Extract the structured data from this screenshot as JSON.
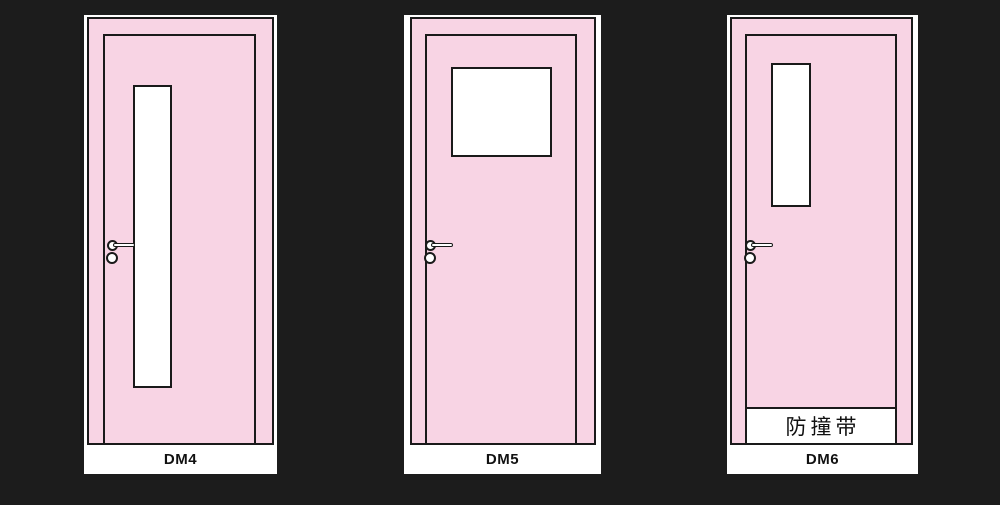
{
  "colors": {
    "background": "#1c1c1c",
    "door_pink": "#f8d4e4",
    "outline": "#1a1a1a",
    "glass_white": "#ffffff",
    "label_text": "#111111"
  },
  "doors": [
    {
      "label": "DM4",
      "window_type": "tall-narrow-glass"
    },
    {
      "label": "DM5",
      "window_type": "square-glass-top"
    },
    {
      "label": "DM6",
      "window_type": "narrow-glass-top",
      "bump_strip_label": "防撞带"
    }
  ],
  "icons": {
    "handle_knob": "circle-with-lever",
    "lock_cylinder": "circle"
  }
}
